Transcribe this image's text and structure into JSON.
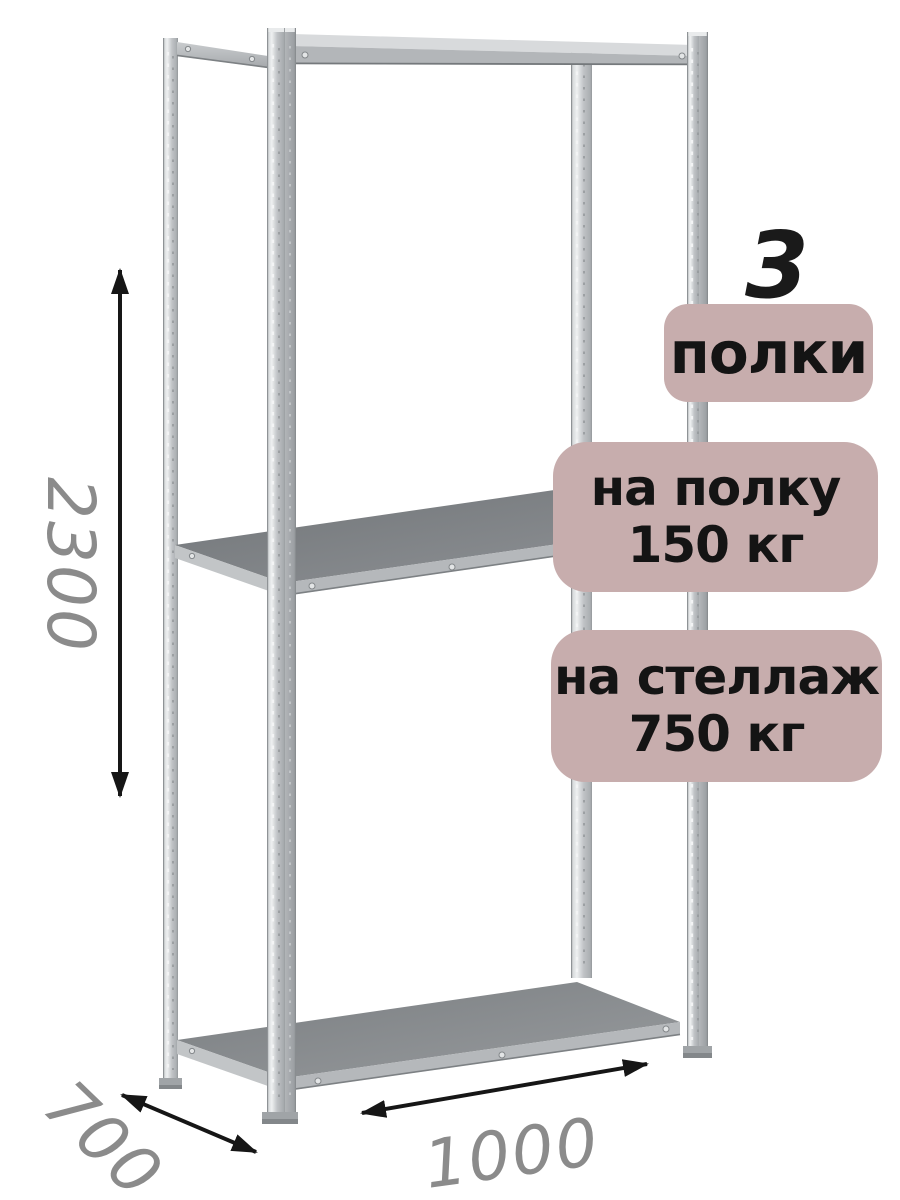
{
  "dimensions": {
    "height": "2300",
    "depth": "700",
    "width": "1000"
  },
  "specs": {
    "shelf_count": "3",
    "shelf_count_label": "полки",
    "shelf_load_line1": "на полку",
    "shelf_load_line2": "150 кг",
    "rack_load_line1": "на стеллаж",
    "rack_load_line2": "750 кг"
  },
  "icons": {
    "height_arrow": "double-headed-vertical-arrow",
    "depth_arrow": "double-headed-diagonal-arrow",
    "width_arrow": "double-headed-horizontal-arrow"
  },
  "colors": {
    "background": "#ffffff",
    "badge_background": "#c7adad",
    "badge_text": "#141414",
    "dimension_text": "#8b8b8b",
    "arrow": "#161616",
    "metal_light": "#eef0f1",
    "metal_mid": "#c0c3c6",
    "metal_dark": "#8c9093",
    "shelf_top_middle": "#7b7f82",
    "shelf_top_bottom": "#8a8e91"
  }
}
